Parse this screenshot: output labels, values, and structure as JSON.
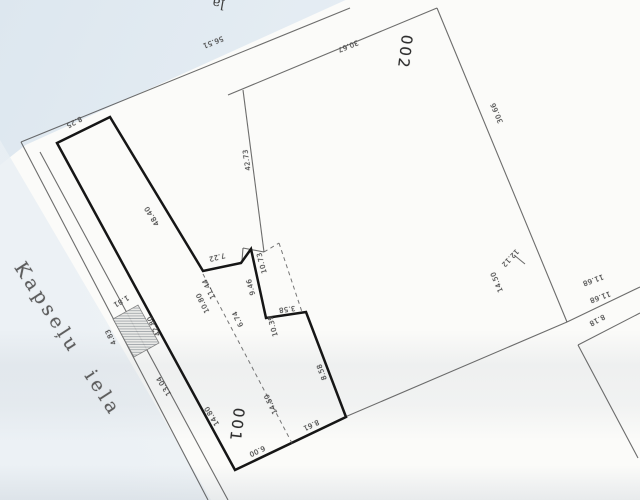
{
  "plan": {
    "street_name": "Kapseļu iela",
    "top_street_fragment": "ļa",
    "parcels": [
      {
        "id": "002"
      },
      {
        "id": "001"
      }
    ],
    "colors": {
      "paper": "#fbfbf9",
      "thin_line": "#4d4d4d",
      "thick_line": "#161616",
      "label_text": "#474747",
      "scan_tint": "#dde7ef"
    },
    "dimension_labels": [
      {
        "text": "56.51",
        "x": 213,
        "y": 42,
        "rot": 158
      },
      {
        "text": "30.67",
        "x": 348,
        "y": 46,
        "rot": 158
      },
      {
        "text": "8.25",
        "x": 74,
        "y": 122,
        "rot": 152
      },
      {
        "text": "48.40",
        "x": 152,
        "y": 216,
        "rot": -122
      },
      {
        "text": "42.73",
        "x": 247,
        "y": 160,
        "rot": -98
      },
      {
        "text": "30.66",
        "x": 497,
        "y": 113,
        "rot": -113
      },
      {
        "text": "12.12",
        "x": 510,
        "y": 258,
        "rot": 133
      },
      {
        "text": "14.50",
        "x": 497,
        "y": 282,
        "rot": -113
      },
      {
        "text": "11.68",
        "x": 593,
        "y": 280,
        "rot": 160
      },
      {
        "text": "11.68",
        "x": 600,
        "y": 297,
        "rot": 160
      },
      {
        "text": "8.18",
        "x": 597,
        "y": 320,
        "rot": 152
      },
      {
        "text": "7.22",
        "x": 217,
        "y": 257,
        "rot": 166
      },
      {
        "text": "10.73",
        "x": 262,
        "y": 263,
        "rot": -105
      },
      {
        "text": "9.46",
        "x": 251,
        "y": 287,
        "rot": -105
      },
      {
        "text": "3.58",
        "x": 287,
        "y": 309,
        "rot": 172
      },
      {
        "text": "11.44",
        "x": 209,
        "y": 289,
        "rot": -116
      },
      {
        "text": "10.80",
        "x": 203,
        "y": 303,
        "rot": -116
      },
      {
        "text": "6.74",
        "x": 238,
        "y": 319,
        "rot": -116
      },
      {
        "text": "10.39",
        "x": 273,
        "y": 326,
        "rot": -105
      },
      {
        "text": "8.58",
        "x": 322,
        "y": 372,
        "rot": -111
      },
      {
        "text": "14.50",
        "x": 271,
        "y": 404,
        "rot": -116
      },
      {
        "text": "8.61",
        "x": 311,
        "y": 425,
        "rot": 155
      },
      {
        "text": "6.00",
        "x": 257,
        "y": 451,
        "rot": 155
      },
      {
        "text": "14.80",
        "x": 212,
        "y": 416,
        "rot": -122
      },
      {
        "text": "13.04",
        "x": 164,
        "y": 386,
        "rot": -122
      },
      {
        "text": "42.80",
        "x": 154,
        "y": 326,
        "rot": -116
      },
      {
        "text": "4.83",
        "x": 111,
        "y": 337,
        "rot": -116
      },
      {
        "text": "1.81",
        "x": 121,
        "y": 301,
        "rot": 150
      }
    ]
  }
}
